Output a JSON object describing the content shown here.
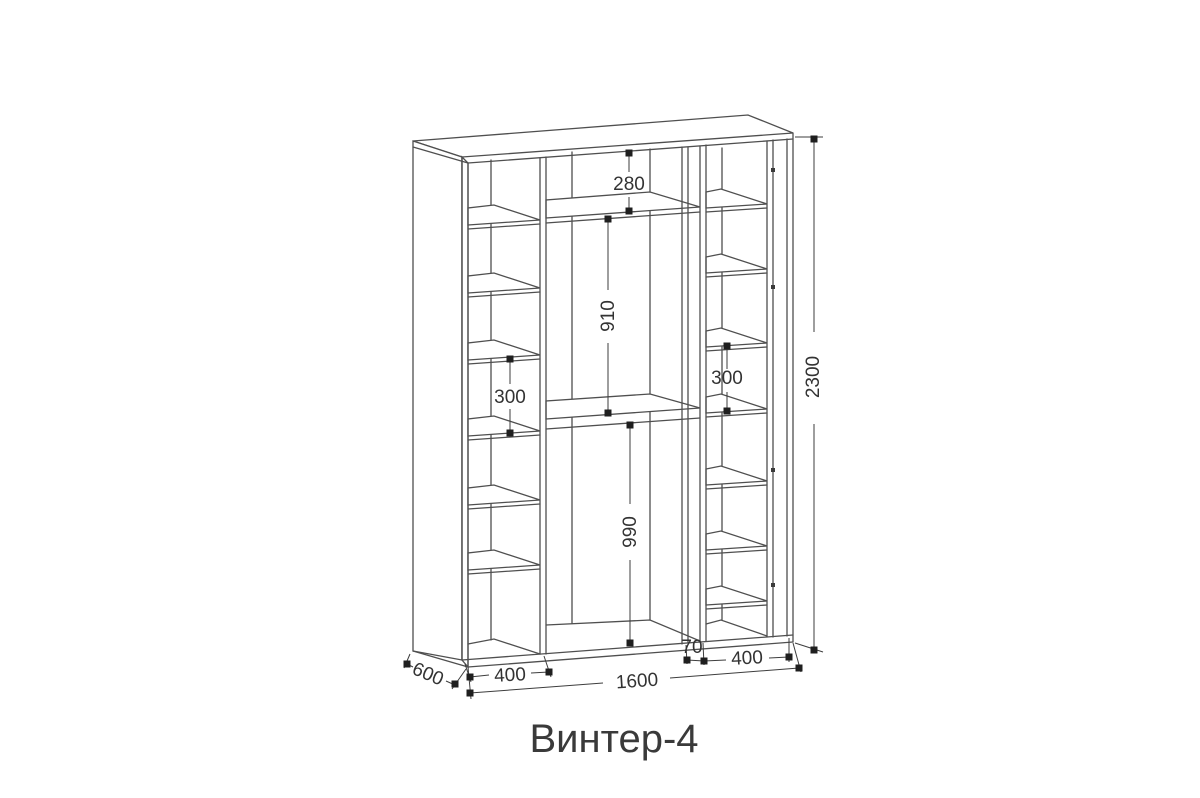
{
  "title": "Винтер-4",
  "colors": {
    "line": "#4f4f4f",
    "dimension_line": "#3d3d3d",
    "text": "#333333",
    "background": "#ffffff"
  },
  "dims": {
    "top_gap": "280",
    "upper_height": "910",
    "lower_height": "990",
    "left_shelf_gap": "300",
    "right_shelf_gap": "300",
    "total_height": "2300",
    "total_width": "1600",
    "left_section_width": "400",
    "right_section_width": "400",
    "partition_gap": "70",
    "depth": "600"
  }
}
